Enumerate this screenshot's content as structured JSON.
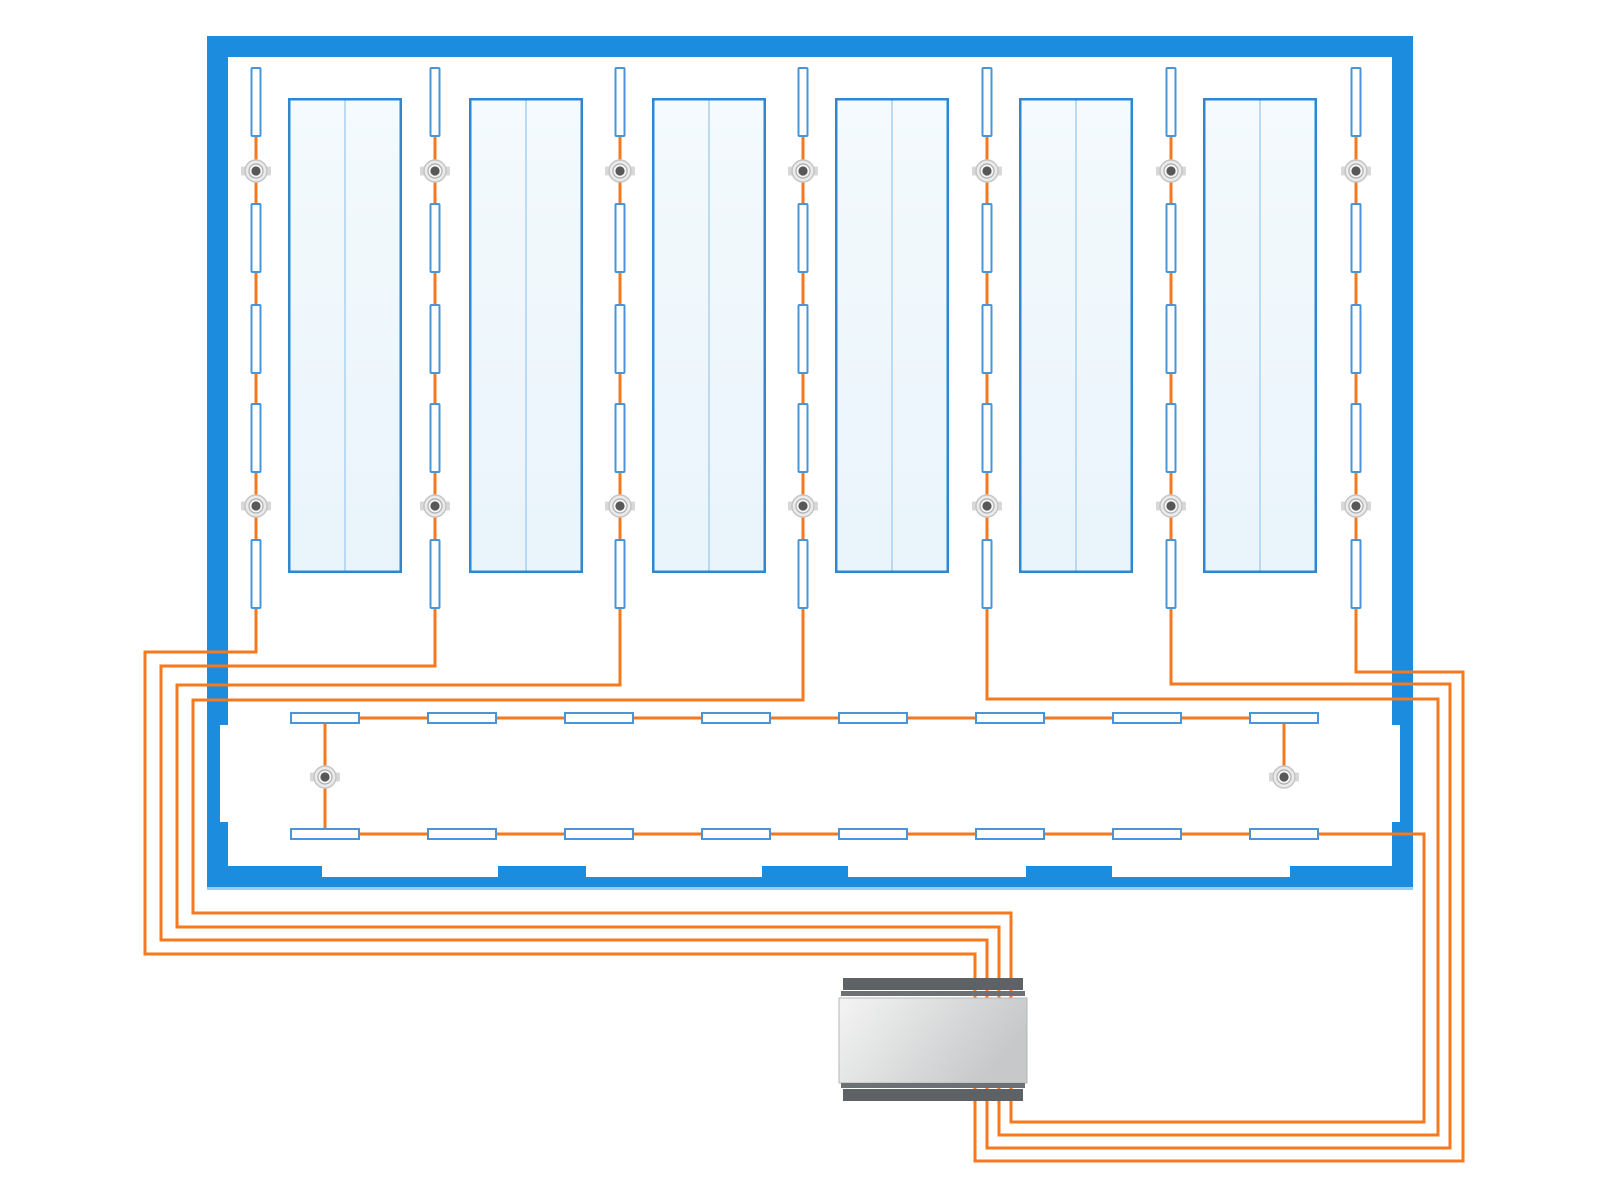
{
  "diagram": {
    "kind": "lighting-control-wiring-floor-plan",
    "canvas": {
      "width": 1600,
      "height": 1200
    },
    "colors": {
      "background": "#ffffff",
      "wall": "#1b8cde",
      "wall_shadow": "#9ccdf0",
      "wire": "#f5791e",
      "luminaire_border": "#4a94da",
      "luminaire_fill": "#ffffff",
      "panel_border": "#2f87d2",
      "panel_fill_light": "#f4fafd",
      "panel_fill": "#e9f4fb",
      "panel_divider": "#abd0ec",
      "sensor_outer": "#eaeaea",
      "sensor_rim": "#c5c5c5",
      "sensor_mid": "#f7f7f7",
      "sensor_mid_rim": "#adadad",
      "sensor_core": "#56585a",
      "sensor_ear": "#d8d8d8",
      "controller_flange": "#5f6264",
      "controller_thin": "#6e7173",
      "controller_body_light": "#f4f4f4",
      "controller_body_dark": "#c6c8c9",
      "controller_stroke": "#b5b7b8"
    },
    "room": {
      "x": 207,
      "y": 36,
      "w": 1206,
      "h": 851,
      "thickness": 21,
      "bottom_openings": [
        [
          322,
          498
        ],
        [
          586,
          762
        ],
        [
          848,
          1026
        ],
        [
          1112,
          1290
        ]
      ],
      "opening_depth": 11,
      "side_recess": {
        "y1": 725,
        "y2": 822,
        "depth": 8
      },
      "shadow_h": 3
    },
    "panels": {
      "y": 98,
      "h": 475,
      "w": 114,
      "xs": [
        288,
        469,
        652,
        835,
        1019,
        1203
      ]
    },
    "strips": {
      "xs": [
        256,
        435,
        620,
        803,
        987,
        1171,
        1356
      ],
      "luminaire_w": 11,
      "luminaire_h": 70,
      "luminaire_ys": [
        67,
        203,
        304,
        403,
        539
      ],
      "sensor_ys": [
        171,
        506
      ],
      "wire_top": 70
    },
    "bottom_zone": {
      "rect_xs": [
        290,
        427,
        564,
        701,
        838,
        975,
        1112,
        1249
      ],
      "rect_w": 70,
      "rect_h": 12,
      "row1_y": 712,
      "row2_y": 828,
      "top_bus": [
        [
          300,
          718
        ],
        [
          1310,
          718
        ]
      ],
      "left_drop": [
        [
          325,
          720
        ],
        [
          325,
          834
        ]
      ],
      "right_drop": [
        [
          1284,
          720
        ],
        [
          1284,
          777
        ]
      ],
      "sensors": [
        [
          325,
          777
        ],
        [
          1284,
          777
        ]
      ]
    },
    "circuits": [
      {
        "name": "circuit-strip-1",
        "points": [
          [
            256,
            70
          ],
          [
            256,
            652
          ],
          [
            145,
            652
          ],
          [
            145,
            954
          ],
          [
            975,
            954
          ],
          [
            975,
            1005
          ]
        ]
      },
      {
        "name": "circuit-strip-2",
        "points": [
          [
            435,
            70
          ],
          [
            435,
            666
          ],
          [
            161,
            666
          ],
          [
            161,
            940
          ],
          [
            987,
            940
          ],
          [
            987,
            1005
          ]
        ]
      },
      {
        "name": "circuit-strip-3",
        "points": [
          [
            620,
            70
          ],
          [
            620,
            685
          ],
          [
            177,
            685
          ],
          [
            177,
            927
          ],
          [
            999,
            927
          ],
          [
            999,
            1005
          ]
        ]
      },
      {
        "name": "circuit-strip-4",
        "points": [
          [
            803,
            70
          ],
          [
            803,
            700
          ],
          [
            193,
            700
          ],
          [
            193,
            913
          ],
          [
            1011,
            913
          ],
          [
            1011,
            1005
          ]
        ]
      },
      {
        "name": "circuit-strip-5",
        "points": [
          [
            987,
            70
          ],
          [
            987,
            699
          ],
          [
            1438,
            699
          ],
          [
            1438,
            1135
          ],
          [
            999,
            1135
          ],
          [
            999,
            1085
          ]
        ]
      },
      {
        "name": "circuit-strip-6",
        "points": [
          [
            1171,
            70
          ],
          [
            1171,
            684
          ],
          [
            1450,
            684
          ],
          [
            1450,
            1148
          ],
          [
            987,
            1148
          ],
          [
            987,
            1085
          ]
        ]
      },
      {
        "name": "circuit-strip-7",
        "points": [
          [
            1356,
            70
          ],
          [
            1356,
            672
          ],
          [
            1463,
            672
          ],
          [
            1463,
            1161
          ],
          [
            975,
            1161
          ],
          [
            975,
            1085
          ]
        ]
      },
      {
        "name": "circuit-bottom-zone",
        "points": [
          [
            300,
            834
          ],
          [
            1424,
            834
          ],
          [
            1424,
            1122
          ],
          [
            1011,
            1122
          ],
          [
            1011,
            1085
          ]
        ]
      }
    ],
    "wire_width": 3,
    "controller": {
      "body": {
        "x": 839,
        "y": 998,
        "w": 188,
        "h": 85
      },
      "top_flange": {
        "x": 843,
        "y": 978,
        "w": 180,
        "h": 12
      },
      "top_thin": {
        "x": 841,
        "y": 991,
        "w": 184,
        "h": 5
      },
      "bot_thin": {
        "x": 841,
        "y": 1083,
        "w": 184,
        "h": 5
      },
      "bot_flange": {
        "x": 843,
        "y": 1089,
        "w": 180,
        "h": 12
      }
    }
  }
}
